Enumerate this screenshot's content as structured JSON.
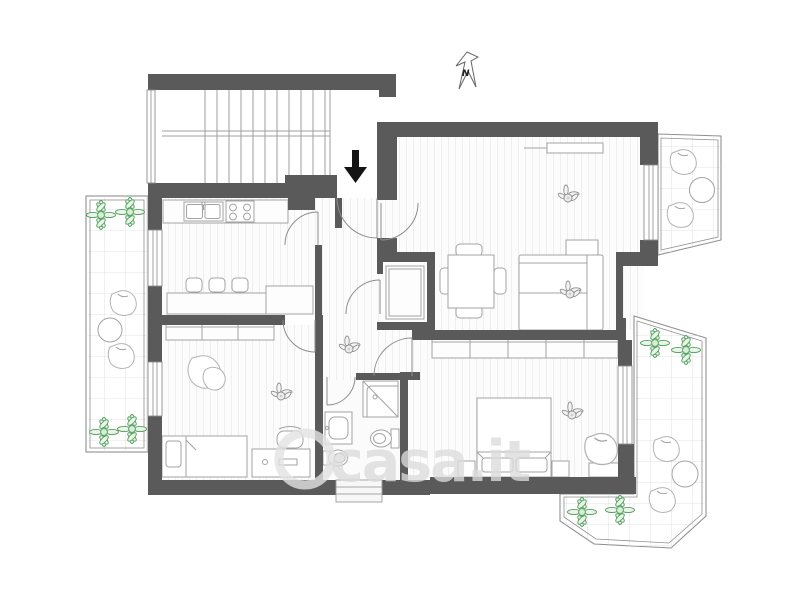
{
  "image": {
    "kind": "apartment-floor-plan",
    "background": "#ffffff"
  },
  "compass": {
    "label": "N"
  },
  "entrance": {
    "symbol": "down-arrow"
  },
  "watermark": {
    "text": "casa.it"
  },
  "palette": {
    "wall": "#5a5a5a",
    "furniture_line": "#a3a3a3",
    "door_line": "#8d8d8d",
    "balcony_line": "#909090",
    "tile_grid": "#dadada",
    "plank_stripe": "#efefef",
    "plant_green": "#4f9d58",
    "plant_green_fill": "#eaf4ea",
    "plant_gray": "#8f8f8f",
    "entrance_arrow": "#141414",
    "watermark_gray": "#dcdcdc"
  }
}
